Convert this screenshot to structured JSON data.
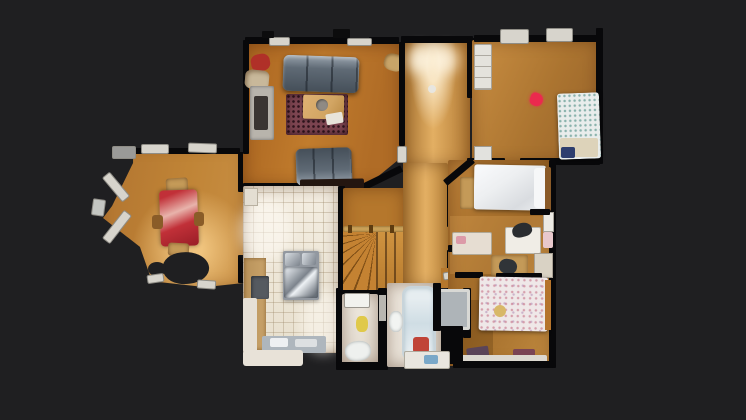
{
  "scene": {
    "name": "3d-scan-floorplan-top-down-view",
    "type": "residential-single-floor",
    "background": "#1f1f21"
  },
  "colors": {
    "bg": "#1f1f21",
    "wall": "#08080a",
    "wood-living-a": "#a96420",
    "wood-living-b": "#c17c2d",
    "wood-dining": "#b97f36",
    "wood-dining-hi": "#f0c47e",
    "wood-hall": "#c28740",
    "wood-hall-hi": "#e3af63",
    "wood-right-a": "#bb8038",
    "wood-right-b": "#a06a28",
    "wood-bed-tr-a": "#c98e42",
    "wood-bed-tr-b": "#96622a",
    "wood-stairs": "#b5772c",
    "tread": "#c48232",
    "tread-dark": "#7e4e16",
    "tile": "#ece4d3",
    "tile-line": "#96805f",
    "bath-floor": "#e9e2d8",
    "rug": "#7c4450",
    "rug-dot": "#2e141c",
    "sofa": "#5f6a75",
    "sofa-hi": "#98a2ac",
    "sofa-dark": "#454f59",
    "table-red": "#c13038",
    "red-sheen": "#e8b3ab",
    "chair-wood": "#c49a58",
    "coffee-table": "#d2a563",
    "bed-white": "#edeff1",
    "bed-tr-base": "#e9edec",
    "bed-tr-dot": "#3c8278",
    "pillow-tan": "#ddd3ba",
    "navy-item": "#2e3e6e",
    "floral-base": "#efe8e8",
    "floral-dot": "#c8788c",
    "tub": "#e6edf0",
    "tub-edge": "#c8d4da",
    "steel-a": "#d8dde2",
    "steel-b": "#7c838c",
    "island": "#9298a0",
    "counter": "#aeb6bd",
    "cabinet-tan": "#c9a36a",
    "stove-dark": "#555a60",
    "white-furn": "#d7d4cc",
    "tag-red": "#ea2a4e",
    "yellow-item": "#e0c94a",
    "red-mat": "#c04438",
    "purple-item": "#5a4458"
  },
  "rooms": [
    {
      "id": "living-room",
      "furniture": [
        "sofa",
        "loveseat",
        "area-rug",
        "coffee-table",
        "fireplace",
        "red-armchair",
        "tan-armchair",
        "console-table"
      ]
    },
    {
      "id": "dining-room",
      "furniture": [
        "red-dining-table",
        "dining-chairs",
        "bay-windows"
      ],
      "artifact": "scan-hole"
    },
    {
      "id": "kitchen",
      "furniture": [
        "island-cooktop",
        "stainless-pans",
        "lower-cabinets",
        "range",
        "sink-counter"
      ]
    },
    {
      "id": "hallway",
      "furniture": [
        "ceiling-lights"
      ]
    },
    {
      "id": "staircase",
      "furniture": [
        "winder-treads",
        "railing",
        "balusters"
      ]
    },
    {
      "id": "bedroom-top-right",
      "furniture": [
        "bed-blue-pattern",
        "dresser",
        "window-ac-units"
      ],
      "marker": "red-tag"
    },
    {
      "id": "bedroom-middle-right",
      "furniture": [
        "double-bed-white",
        "wood-bench",
        "radiator"
      ]
    },
    {
      "id": "study",
      "furniture": [
        "desk-white",
        "office-chair",
        "side-table",
        "chair",
        "changing-table",
        "shelf"
      ]
    },
    {
      "id": "bedroom-bottom-right",
      "furniture": [
        "bed-floral",
        "dressers",
        "baseboard-shelf"
      ]
    },
    {
      "id": "bathroom-main",
      "furniture": [
        "bathtub",
        "toilet",
        "vanity",
        "red-mat"
      ]
    },
    {
      "id": "bathroom-small",
      "furniture": [
        "sink",
        "toilet",
        "laundry-basket"
      ]
    },
    {
      "id": "shower-room",
      "furniture": [
        "shower-stall"
      ]
    }
  ]
}
